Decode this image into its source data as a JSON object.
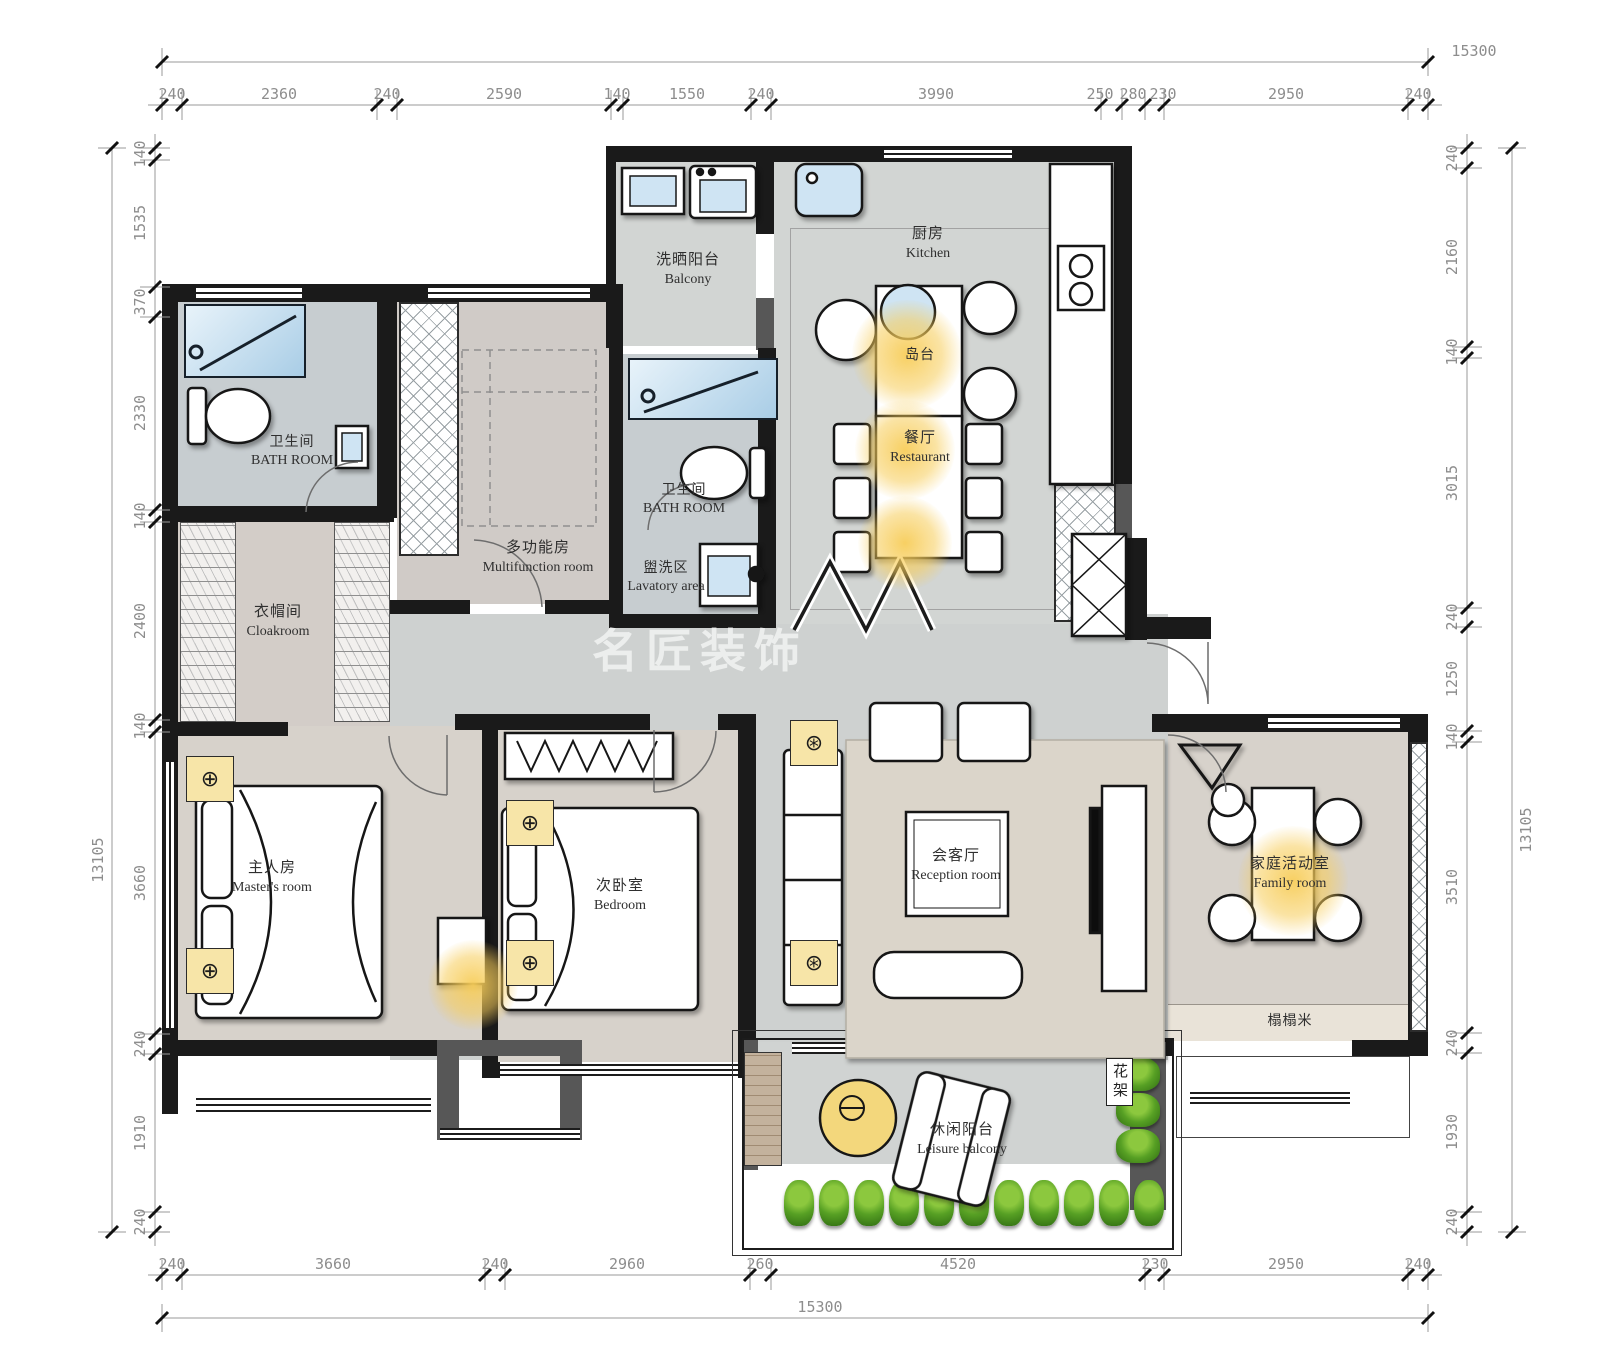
{
  "watermark": "名匠装饰",
  "rooms": {
    "laundry_balcony": {
      "zh": "洗晒阳台",
      "en": "Balcony"
    },
    "kitchen": {
      "zh": "厨房",
      "en": "Kitchen"
    },
    "island": {
      "zh": "岛台"
    },
    "dining": {
      "zh": "餐厅",
      "en": "Restaurant"
    },
    "bath1": {
      "zh": "卫生间",
      "en": "BATH ROOM"
    },
    "bath2": {
      "zh": "卫生间",
      "en": "BATH ROOM"
    },
    "multifunction": {
      "zh": "多功能房",
      "en": "Multifunction room"
    },
    "lavatory": {
      "zh": "盥洗区",
      "en": "Lavatory area"
    },
    "cloakroom": {
      "zh": "衣帽间",
      "en": "Cloakroom"
    },
    "master": {
      "zh": "主人房",
      "en": "Master's room"
    },
    "bedroom": {
      "zh": "次卧室",
      "en": "Bedroom"
    },
    "reception": {
      "zh": "会客厅",
      "en": "Reception room"
    },
    "family": {
      "zh": "家庭活动室",
      "en": "Family room"
    },
    "tatami": {
      "zh": "榻榻米"
    },
    "leisure_balcony": {
      "zh": "休闲阳台",
      "en": "Leisure balcony"
    },
    "flower_rack": {
      "zh": "花架"
    }
  },
  "dims": {
    "top_total": "15300",
    "bottom_total": "15300",
    "left_total": "13105",
    "right_total": "13105",
    "top": [
      "240",
      "2360",
      "240",
      "2590",
      "140",
      "1550",
      "240",
      "3990",
      "250",
      "280",
      "230",
      "2950",
      "240"
    ],
    "bottom": [
      "240",
      "3660",
      "240",
      "2960",
      "260",
      "4520",
      "230",
      "2950",
      "240"
    ],
    "left": [
      "140",
      "1535",
      "370",
      "2330",
      "140",
      "2400",
      "140",
      "3660",
      "240",
      "1910",
      "240"
    ],
    "right": [
      "240",
      "2160",
      "140",
      "3015",
      "240",
      "1250",
      "140",
      "3510",
      "240",
      "1930",
      "240"
    ]
  }
}
